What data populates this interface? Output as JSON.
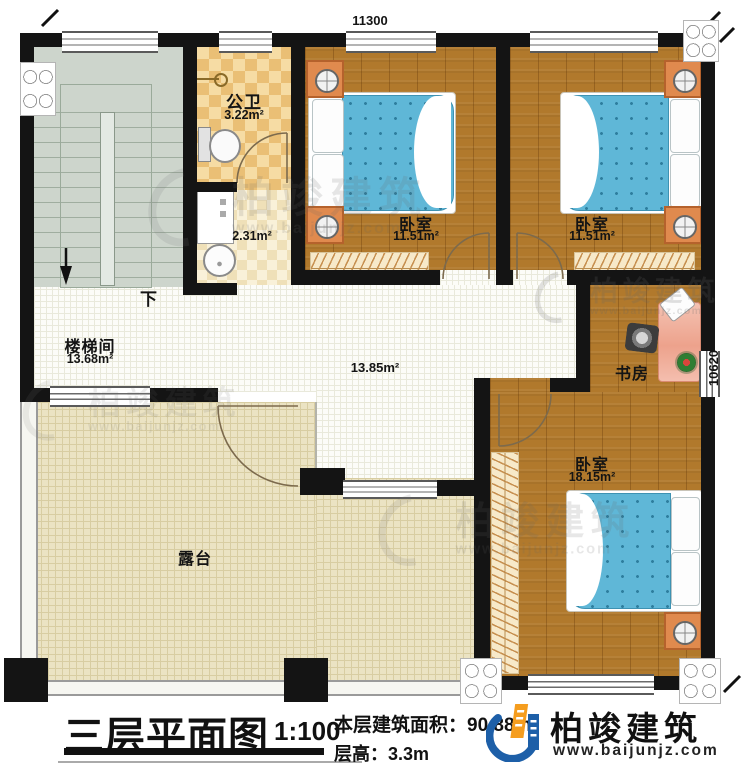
{
  "plan": {
    "dim_top": "11300",
    "dim_right": "10620",
    "stairwell": {
      "name": "楼梯间",
      "area": "13.68m²",
      "down": "下"
    },
    "bathroom": {
      "name": "公卫",
      "area": "3.22m²"
    },
    "washroom": {
      "area": "2.31m²"
    },
    "bedroom1": {
      "name": "卧室",
      "area": "11.51m²"
    },
    "bedroom2": {
      "name": "卧室",
      "area": "11.51m²"
    },
    "bedroom3": {
      "name": "卧室",
      "area": "18.15m²"
    },
    "study": {
      "name": "书房"
    },
    "hall": {
      "area": "13.85m²"
    },
    "terrace": {
      "name": "露台"
    }
  },
  "title_block": {
    "title": "三层平面图",
    "scale": "1:100",
    "area_label": "本层建筑面积：",
    "area_value": "90.88m²",
    "height_label": "层高：",
    "height_value": "3.3m"
  },
  "branding": {
    "company": "柏竣建筑",
    "website": "www.baijunjz.com"
  },
  "watermark": {
    "company": "柏竣建筑",
    "website": "www.baijunjz.com"
  },
  "colors": {
    "wall": "#141414",
    "wood_floor": "#b1792c",
    "bed_blue": "#5fb7d7",
    "stair_floor": "#cdd5cc",
    "tile_orange": "#eabf75",
    "terrace_floor": "#ebe3c3",
    "nightstand_orange": "#e08a4e",
    "desk_pink": "#eda28c",
    "logo_blue": "#1d5fa8",
    "logo_orange": "#f59d1e"
  }
}
